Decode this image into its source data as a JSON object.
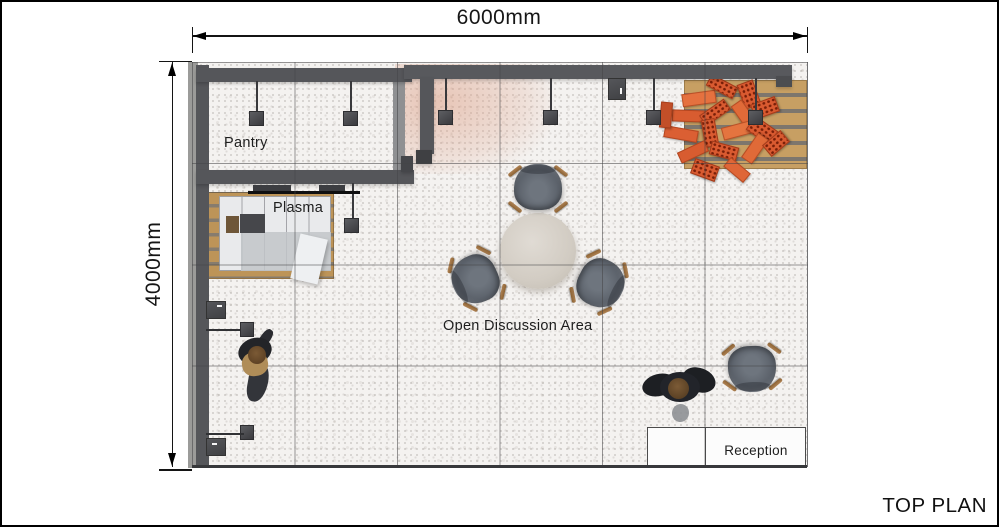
{
  "plan": {
    "title": "TOP PLAN",
    "dim_width": "6000mm",
    "dim_height": "4000mm"
  },
  "rooms": {
    "pantry": "Pantry",
    "plasma": "Plasma",
    "open_discussion": "Open Discussion Area",
    "reception": "Reception"
  },
  "colors": {
    "wall": "#55565a",
    "floor": "#f4f2f0",
    "wood": "#c79f63",
    "brick": "#d95a30",
    "chair": "#575d66",
    "table_top": "#d2ccc3",
    "annotation": "#141414"
  }
}
